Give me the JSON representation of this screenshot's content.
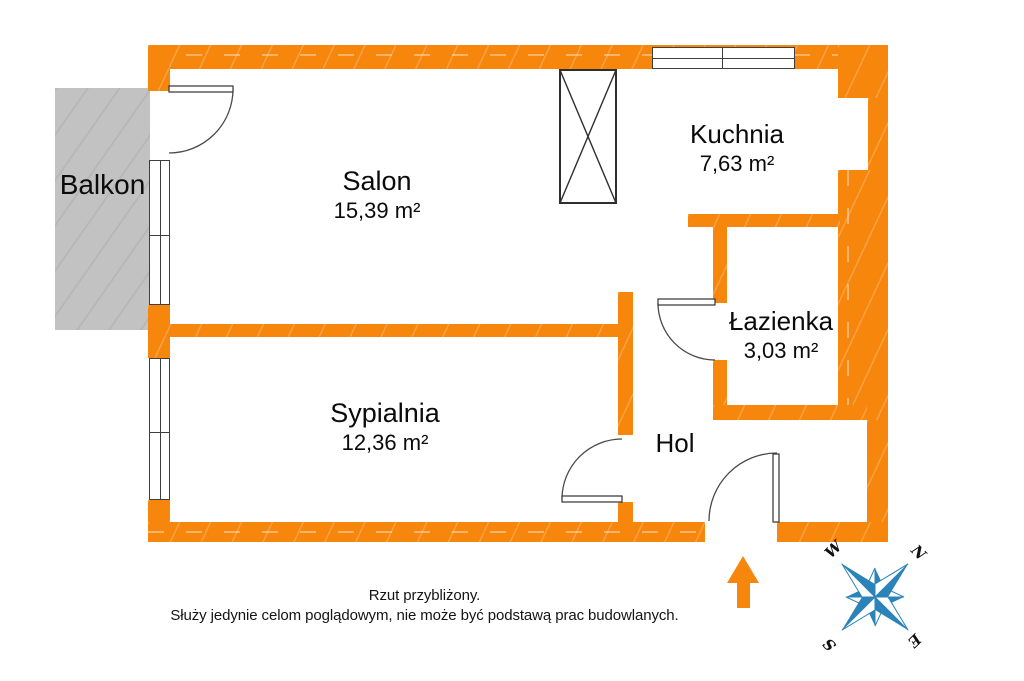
{
  "rooms": {
    "salon": {
      "name": "Salon",
      "area": "15,39 m²"
    },
    "sypialnia": {
      "name": "Sypialnia",
      "area": "12,36 m²"
    },
    "kuchnia": {
      "name": "Kuchnia",
      "area": "7,63 m²"
    },
    "lazienka": {
      "name": "Łazienka",
      "area": "3,03 m²"
    },
    "hol": {
      "name": "Hol"
    },
    "balkon": {
      "name": "Balkon"
    }
  },
  "disclaimer": {
    "line1": "Rzut przybliżony.",
    "line2": "Służy jedynie celom poglądowym, nie może być podstawą prac budowlanych."
  },
  "compass": {
    "n": "N",
    "e": "E",
    "s": "S",
    "w": "W"
  },
  "icons": {
    "entrance_arrow": "up-arrow",
    "orientation": "compass-rose",
    "shaft": "crossed-box-duct"
  },
  "colors": {
    "wall": "#F7860D",
    "balcony": "#C2C2C2",
    "compass_blue": "#2C83B8",
    "line": "#3F3F3F"
  }
}
